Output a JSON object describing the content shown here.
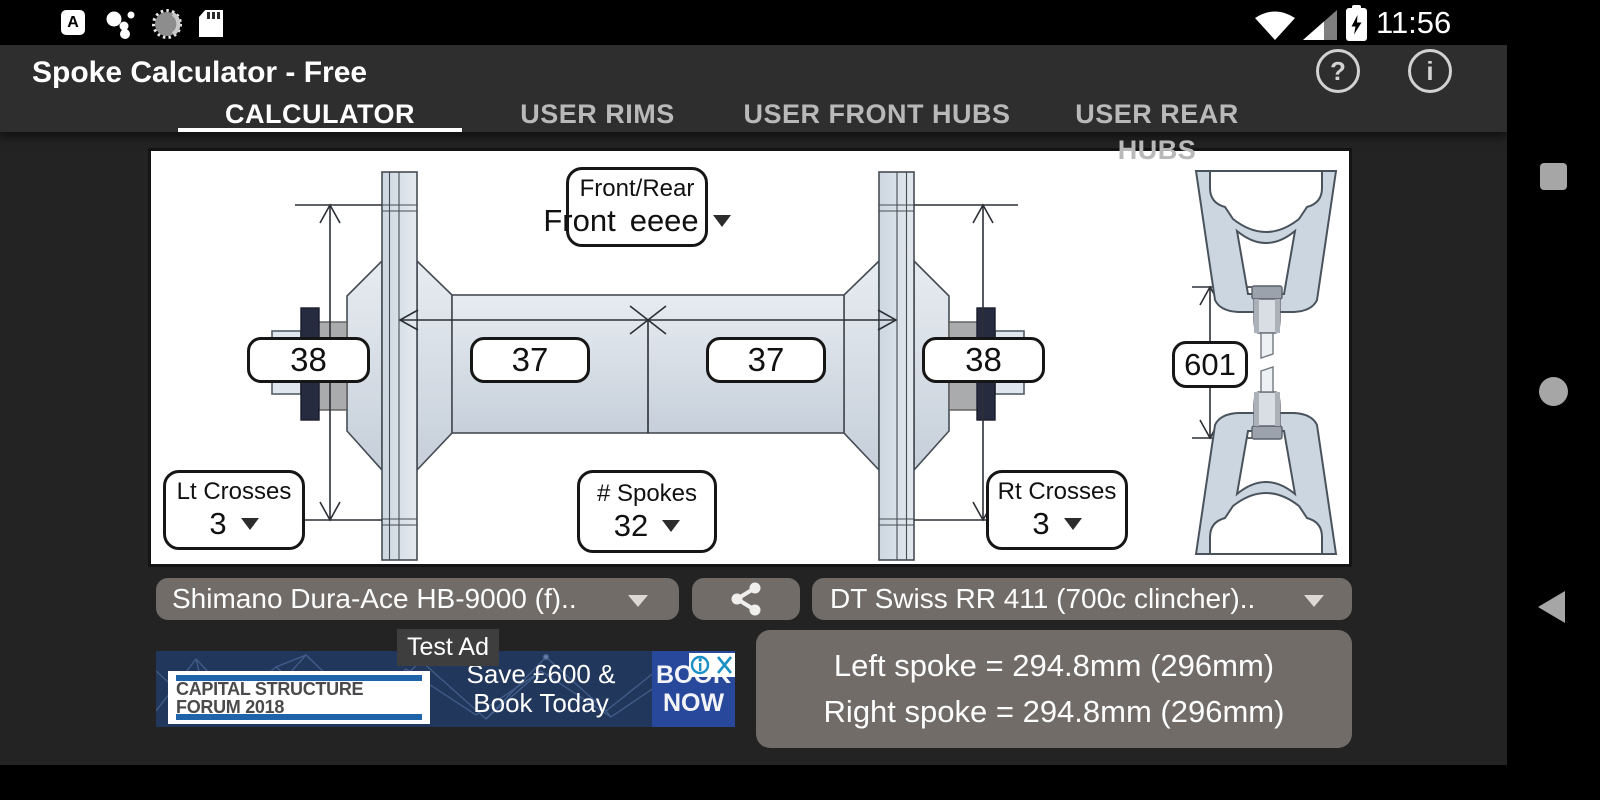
{
  "status_bar": {
    "time": "11:56",
    "icons": {
      "a_badge": "A",
      "assistant_dots": "google-dots-icon",
      "spinner": "loading-spinner-icon",
      "sd_card": "sd-card-icon",
      "wifi": "wifi-icon",
      "signal": "cell-signal-icon",
      "battery": "battery-charging-icon"
    }
  },
  "app_bar": {
    "title": "Spoke Calculator - Free",
    "help_glyph": "?",
    "info_glyph": "i"
  },
  "tabs": [
    {
      "label": "CALCULATOR",
      "active": true
    },
    {
      "label": "USER RIMS",
      "active": false
    },
    {
      "label": "USER FRONT HUBS",
      "active": false
    },
    {
      "label": "USER REAR HUBS",
      "active": false
    }
  ],
  "diagram": {
    "front_rear": {
      "label": "Front/Rear",
      "value": "Front"
    },
    "left_flange_diameter": "38",
    "left_center_to_flange": "37",
    "right_center_to_flange": "37",
    "right_flange_diameter": "38",
    "rim_erd": "601",
    "lt_crosses": {
      "label": "Lt Crosses",
      "value": "3"
    },
    "spokes": {
      "label": "# Spokes",
      "value": "32"
    },
    "rt_crosses": {
      "label": "Rt Crosses",
      "value": "3"
    }
  },
  "controls": {
    "hub_select": "Shimano Dura-Ace HB-9000 (f)..",
    "rim_select": "DT Swiss RR 411 (700c clincher).."
  },
  "results": {
    "left": "Left spoke = 294.8mm (296mm)",
    "right": "Right spoke = 294.8mm (296mm)"
  },
  "ad": {
    "label": "Test Ad",
    "logo_line1": "CAPITAL STRUCTURE",
    "logo_line2": "FORUM 2018",
    "offer_line1": "Save £600 &",
    "offer_line2": "Book Today",
    "cta_line1": "BOOK",
    "cta_line2": "NOW"
  },
  "colors": {
    "app_bar": "#2e2e2e",
    "content_bg": "#232323",
    "button_gray": "#716c68",
    "ad_navy": "#22375c",
    "ad_cta_blue": "#28489c",
    "adchoices_teal": "#1a8fc4",
    "hub_fill": "#d5dee7",
    "active_tab": "#ffffff"
  }
}
